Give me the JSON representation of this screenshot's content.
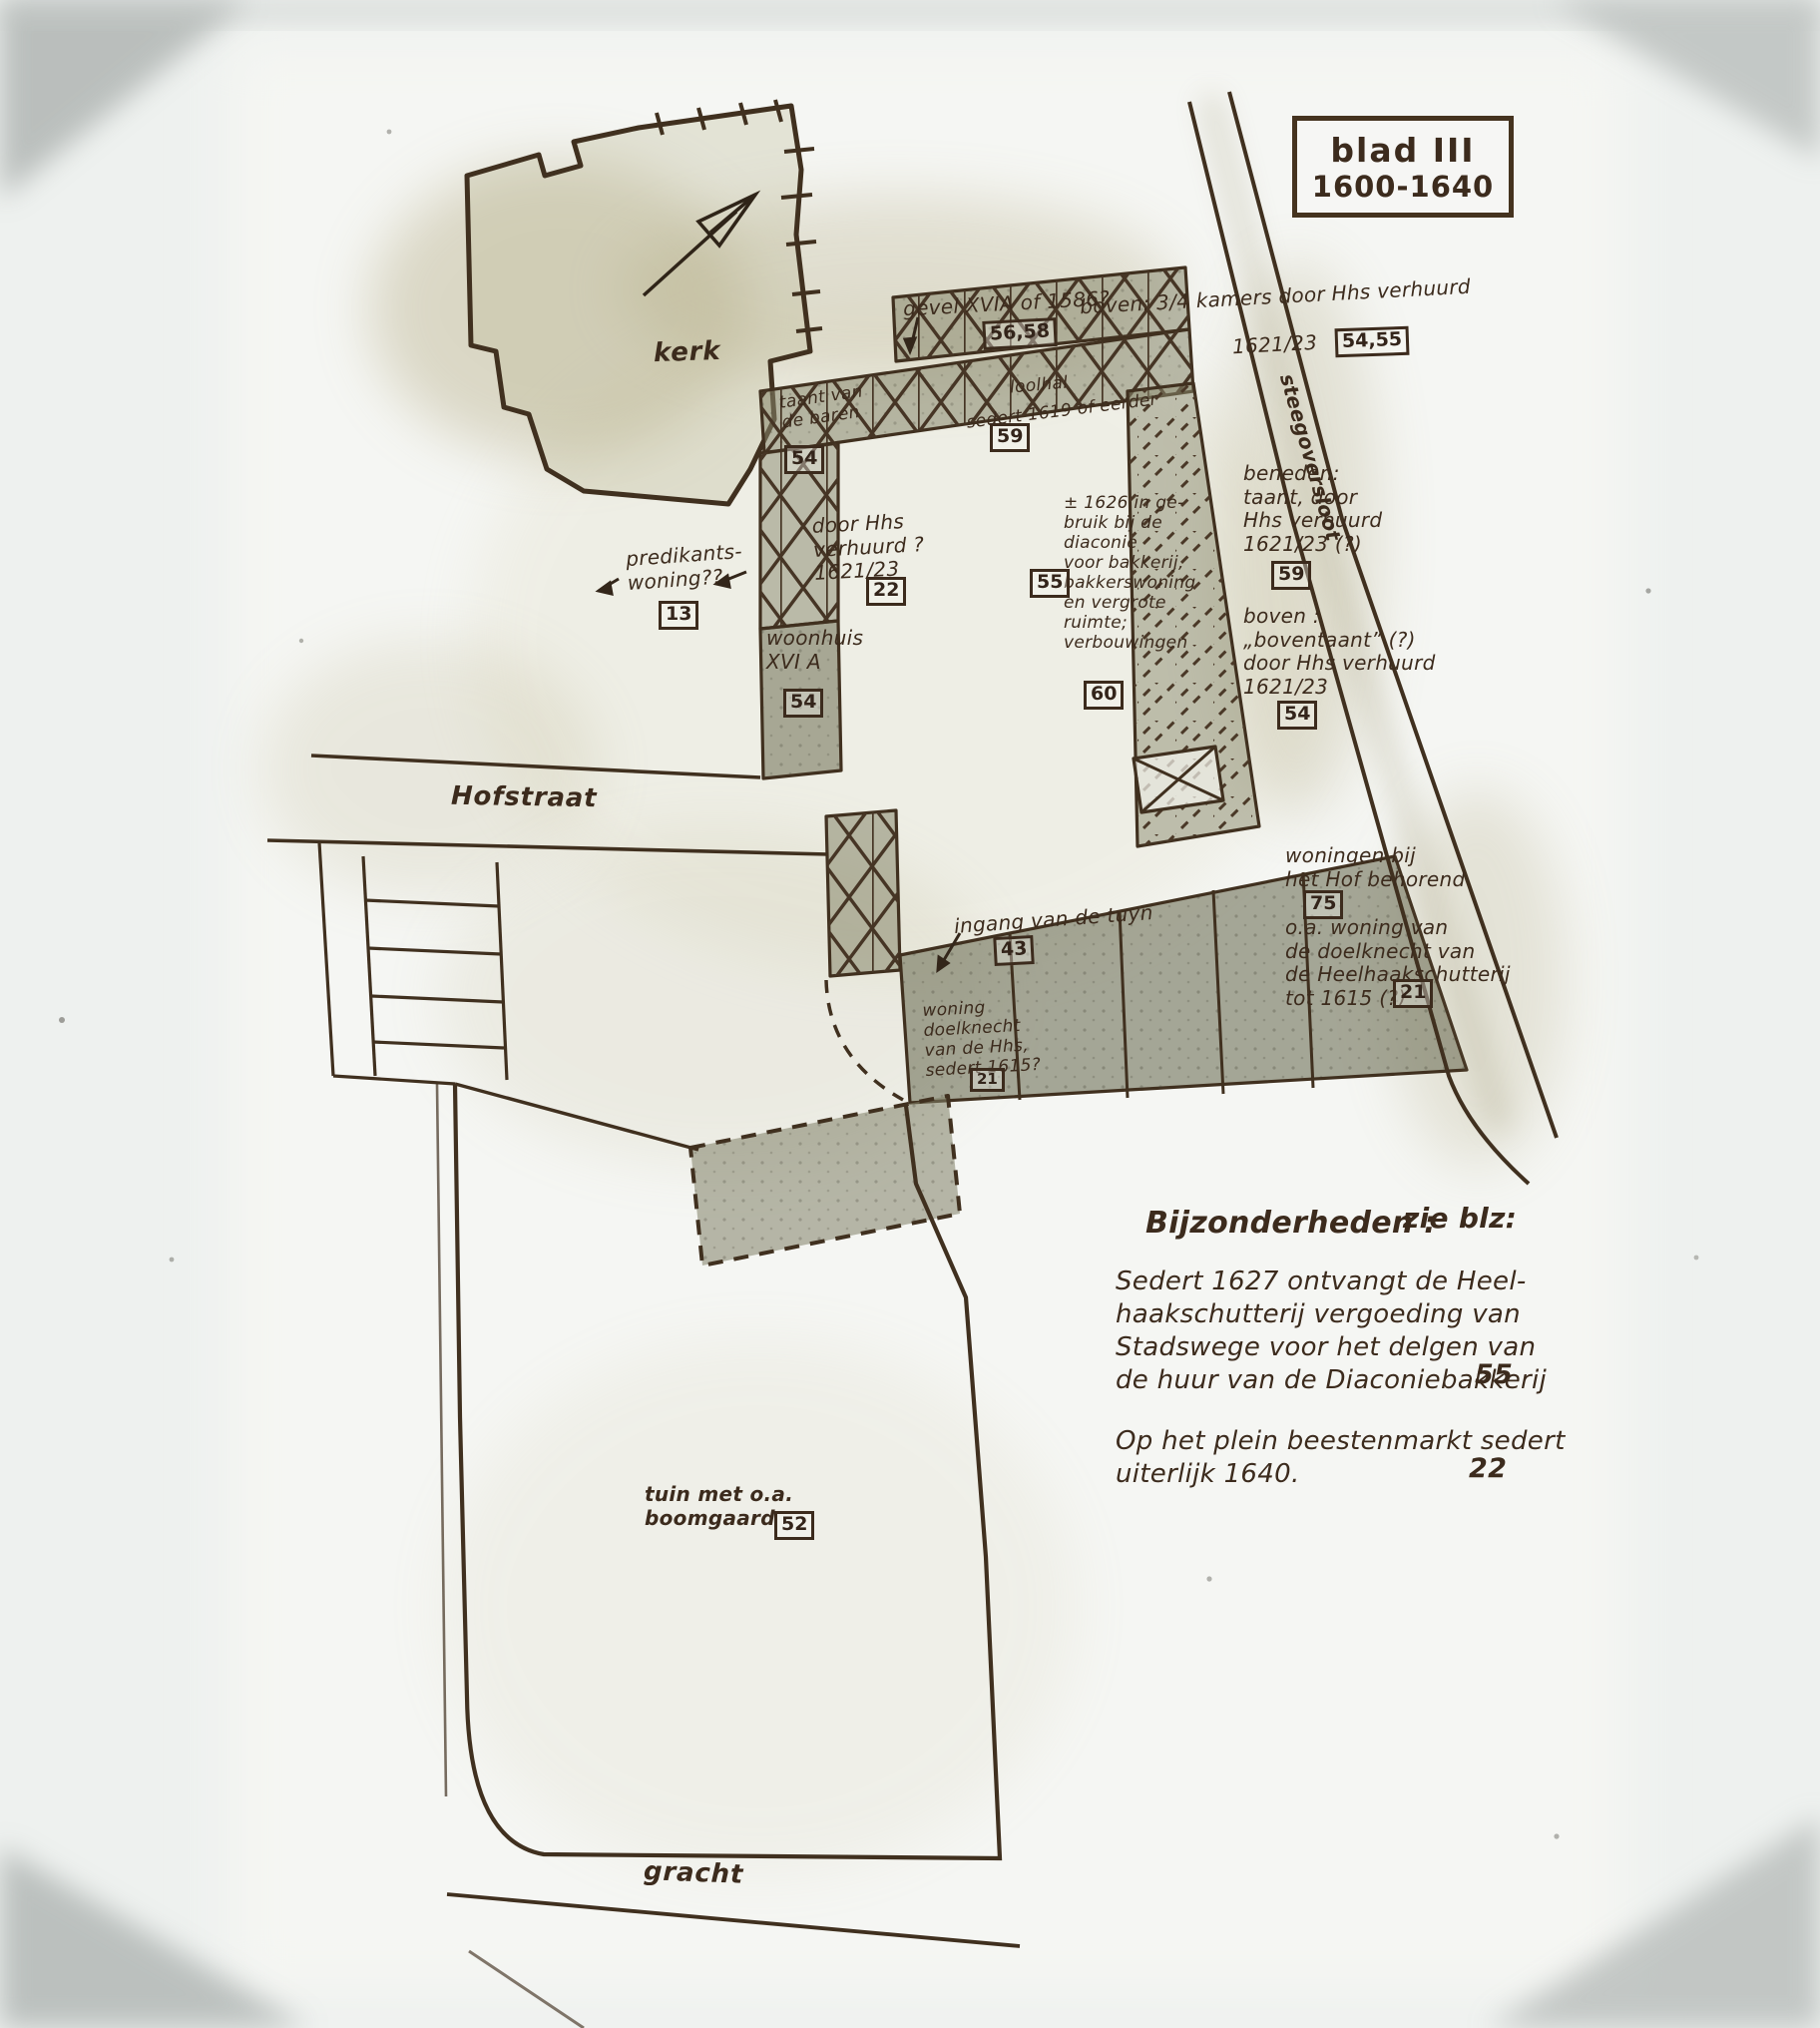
{
  "title_box": {
    "line1": "blad III",
    "line2": "1600-1640"
  },
  "labels": {
    "kerk": "kerk",
    "hofstraat": "Hofstraat",
    "gracht": "gracht",
    "steegoversloot": "steegoversloot"
  },
  "annotations": {
    "gevel": {
      "text": "gevel  XVIA of 1586?",
      "ref": "56,58"
    },
    "boven_kamers": {
      "text": "boven: 3/4 kamers door Hhs verhuurd",
      "text2": "1621/23",
      "ref": "54,55"
    },
    "taant_baren": {
      "text": "taant van\nde baren",
      "ref": "54"
    },
    "loolhal": {
      "text": "loolhal",
      "text2": "sedert 1619 of eerder",
      "ref": "59"
    },
    "predikants": {
      "text": "predikants-\nwoning??",
      "ref": "13"
    },
    "door_hhs": {
      "text": "door Hhs\nverhuurd ?\n1621/23",
      "ref": "22"
    },
    "woonhuis": {
      "text": "woonhuis\nXVI A",
      "ref": "54"
    },
    "diaconie": {
      "text": "± 1626 in ge-\nbruik bij de\ndiaconie\nvoor bakkerij,\nbakkerswoning\nen vergrote\nruimte;\nverbouwingen",
      "ref": "60",
      "ref2": "55"
    },
    "beneden": {
      "text": "beneden:\ntaant, door\nHhs verhuurd\n1621/23 (?)",
      "ref": "59"
    },
    "boven_taant": {
      "text": "boven :\n„boventaant” (?)\ndoor Hhs verhuurd\n1621/23",
      "ref": "54"
    },
    "woningen_hof": {
      "text": "woningen bij\nhet Hof behorend",
      "ref": "75"
    },
    "oa_woning": {
      "text": "o.a. woning van\nde doelknecht van\nde Heelhaakschutterij\ntot 1615 (?)",
      "ref": "21"
    },
    "ingang": {
      "text": "ingang van de tuyn",
      "ref": "43"
    },
    "woning_doelknecht": {
      "text": "woning\ndoelknecht\nvan de Hhs,\nsedert 1615?",
      "ref": "21"
    },
    "tuin": {
      "text": "tuin met o.a.\nboomgaard",
      "ref": "52"
    }
  },
  "notes": {
    "header": "Bijzonderheden :",
    "see_header": "zie blz:",
    "items": [
      {
        "text": "Sedert 1627 ontvangt de Heel-\nhaakschutterij vergoeding van\nStadswege voor het delgen van\nde huur van de Diaconiebakkerij",
        "page": "55"
      },
      {
        "text": "Op het plein beestenmarkt sedert\nuiterlijk 1640.",
        "page": "22"
      }
    ]
  }
}
